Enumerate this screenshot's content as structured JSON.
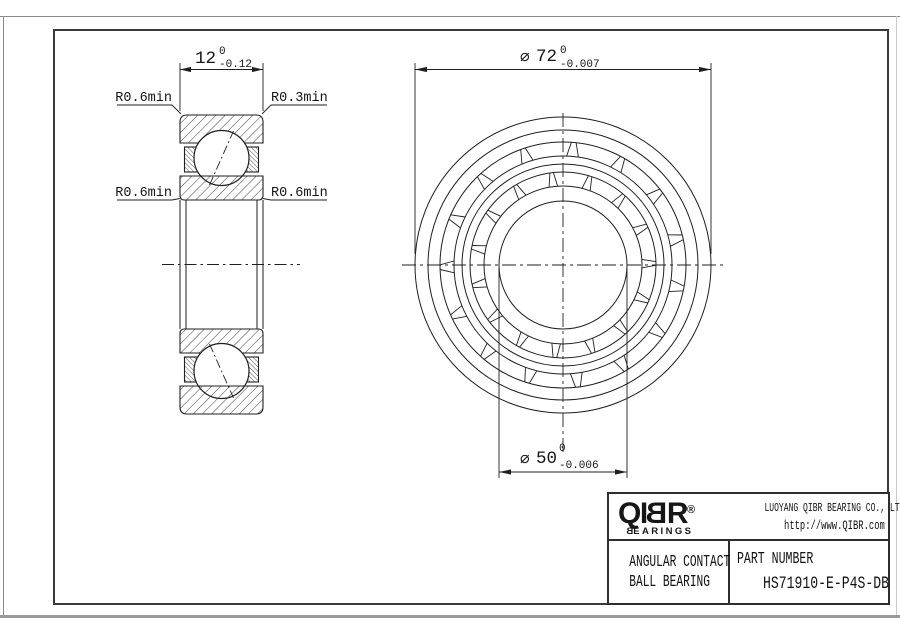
{
  "section_view": {
    "width_dim": {
      "value": "12",
      "tol_upper": "0",
      "tol_lower": "-0.12"
    },
    "radius_labels": {
      "top_left": "R0.6min",
      "top_right": "R0.3min",
      "bottom_left": "R0.6min",
      "bottom_right": "R0.6min"
    }
  },
  "front_view": {
    "outer_dia_dim": {
      "symbol": "∅",
      "value": "72",
      "tol_upper": "0",
      "tol_lower": "-0.007"
    },
    "bore_dia_dim": {
      "symbol": "∅",
      "value": "50",
      "tol_upper": "0",
      "tol_lower": "-0.006"
    }
  },
  "title_block": {
    "logo": {
      "pre": "QI",
      "mirrored_letter": "B",
      "post": "R",
      "registered": "®",
      "sub_mirrored": "B",
      "sub_rest": "EARINGS"
    },
    "company_name": "LUOYANG QIBR BEARING CO., LTD",
    "website": "http://www.QIBR.com",
    "product_type_line1": "ANGULAR CONTACT",
    "product_type_line2": "BALL BEARING",
    "part_number_label": "PART NUMBER",
    "part_number": "HS71910-E-P4S-DB"
  },
  "colors": {
    "line": "#1f1f1f",
    "frame": "#3a3a3a",
    "page_border": "#8a8a8a"
  }
}
